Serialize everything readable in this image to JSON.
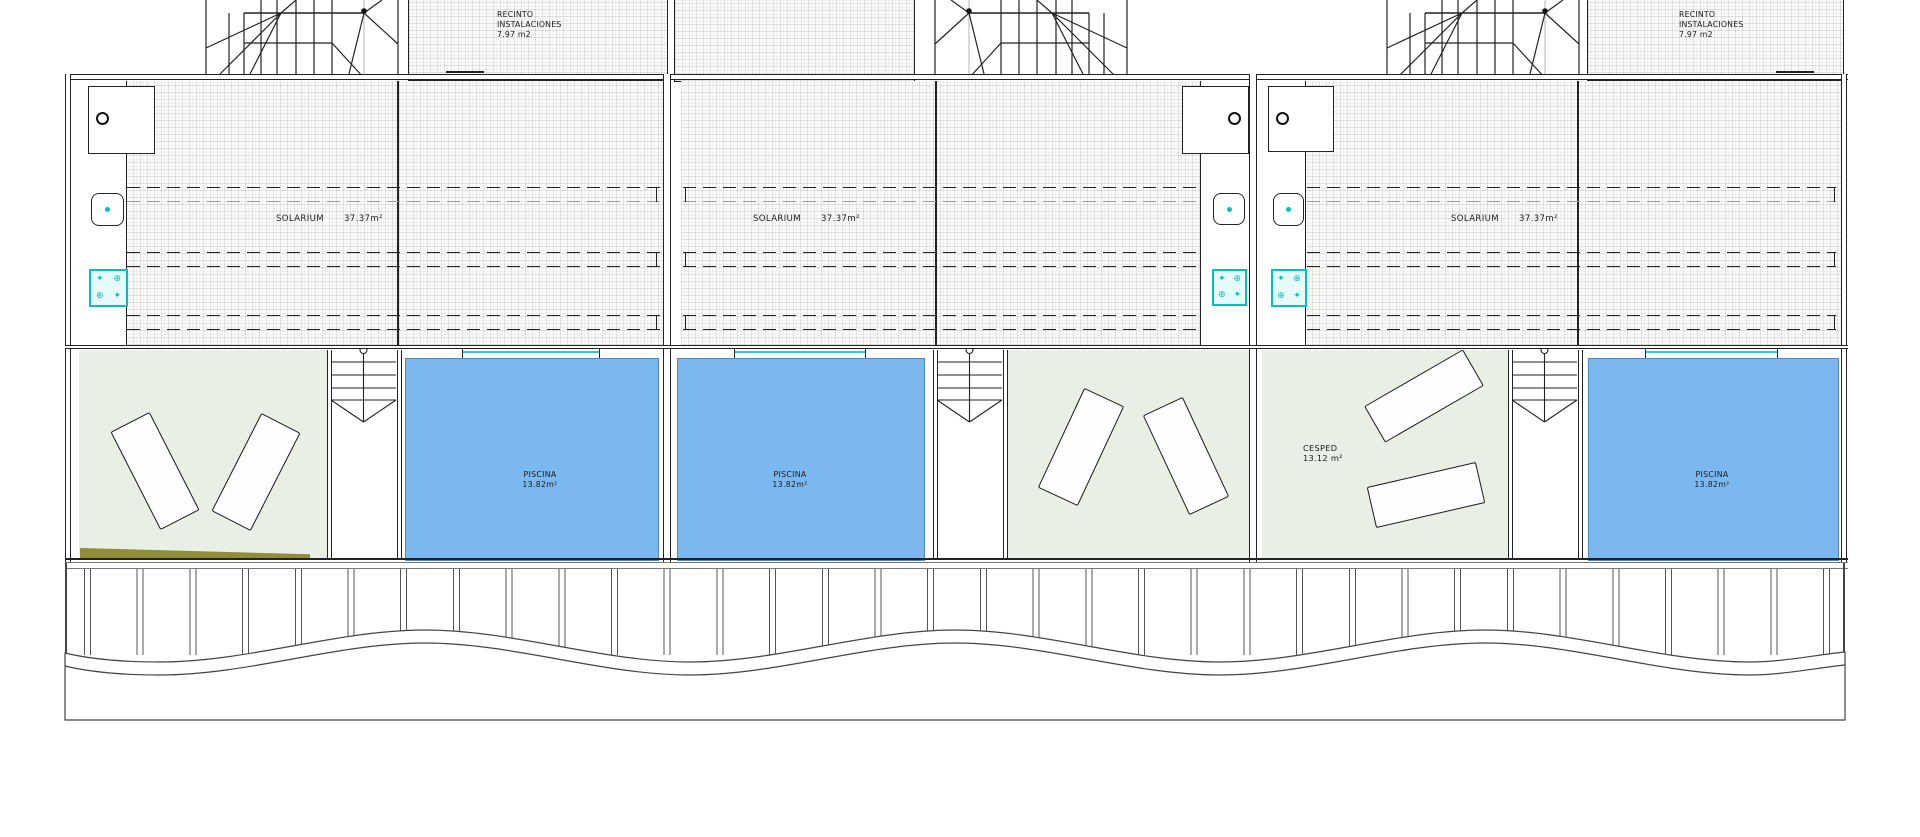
{
  "labels": {
    "solarium": "SOLARIUM",
    "solarium_area": "37.37m²",
    "piscina": "PISCINA",
    "piscina_area": "13.82m²",
    "cesped": "CESPED",
    "cesped_area": "13.12 m²",
    "recinto_line1": "RECINTO",
    "recinto_line2": "INSTALACIONES",
    "recinto_line3": "7.97 m2"
  },
  "colors": {
    "pool": "#7cb8f0",
    "pool_border": "#4e88c0",
    "lawn": "#e9efe4",
    "cyan": "#00bfbf",
    "cyan_fill": "#e6fafa",
    "olive": "#8f8c3a"
  }
}
